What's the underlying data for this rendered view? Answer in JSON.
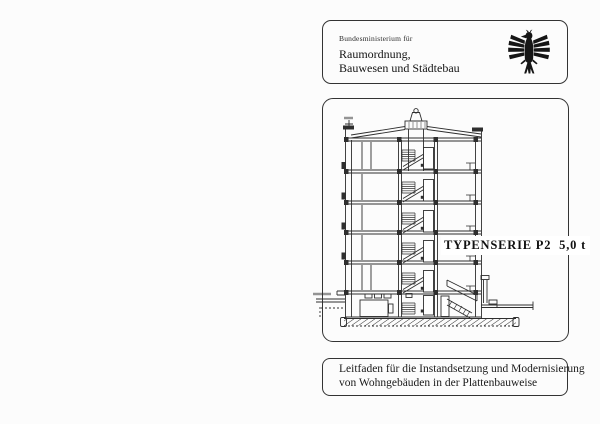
{
  "ministry_box": {
    "department": "Bundesministerium für",
    "name_line1": "Raumordnung,",
    "name_line2": "Bauwesen und Städtebau",
    "emblem_icon": "federal-eagle"
  },
  "drawing_box": {
    "series_label": "TYPENSERIE P2  5,0 t",
    "drawing_icon": "building-cross-section"
  },
  "title_box": {
    "line1": "Leitfaden für die Instandsetzung und Modernisierung",
    "line2": "von Wohngebäuden in der Plattenbauweise"
  },
  "colors": {
    "ink": "#1e1e1e",
    "line": "#2e2e2e",
    "border": "#333333",
    "paper": "#fcfcfc"
  }
}
